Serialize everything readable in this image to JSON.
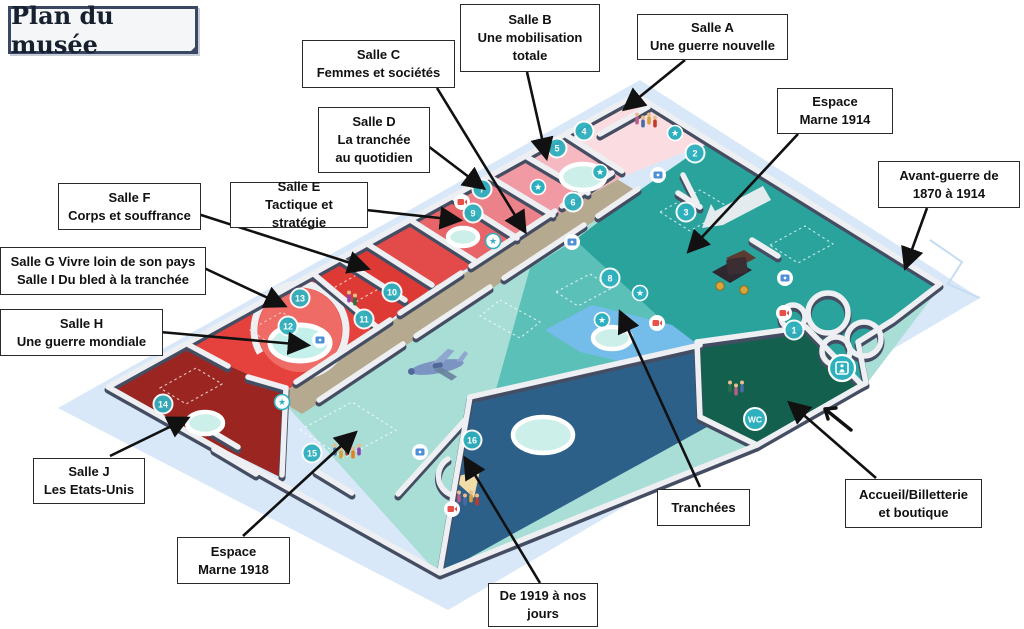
{
  "title": "Plan du musée",
  "labels": {
    "salle_b": "Salle B\nUne mobilisation\ntotale",
    "salle_a": "Salle A\nUne guerre nouvelle",
    "salle_c": "Salle C\nFemmes et sociétés",
    "salle_d": "Salle D\nLa tranchée\nau quotidien",
    "marne_1914": "Espace\nMarne 1914",
    "salle_f": "Salle F\nCorps et souffrance",
    "salle_e": "Salle E\nTactique et stratégie",
    "avant_guerre": "Avant-guerre de\n1870 à 1914",
    "salle_g_i": "Salle G Vivre loin de son pays\nSalle I Du bled à la tranchée",
    "salle_h": "Salle H\nUne guerre mondiale",
    "salle_j": "Salle J\nLes Etats-Unis",
    "marne_1918": "Espace\nMarne 1918",
    "tranchees": "Tranchées",
    "accueil": "Accueil/Billetterie\net boutique",
    "de_1919": "De 1919 à nos\njours"
  },
  "map": {
    "colors": {
      "bg_diamond": "#D8E8F8",
      "teal_dark": "#2AA39D",
      "teal_medium": "#5BC0B8",
      "teal_light": "#A9DED6",
      "navy": "#2D6089",
      "green": "#14604E",
      "corridor": "#B5A98F",
      "dark_red": "#9B2621",
      "red_h": "#E6423D",
      "court": "#EE6B66",
      "pond": "#74BCE9",
      "wall_face": "#EDEFF2",
      "wall_top": "#454D63",
      "room_a": "#FBDCE1",
      "room_b": "#F6B9C1",
      "room_c": "#F19AA4",
      "room_d": "#EC8289",
      "room_e": "#E76568",
      "room_f": "#E24B49",
      "room_g": "#DD3A36",
      "marker": "#2FB0BE",
      "badge_blue": "#4E8FD8",
      "badge_red": "#E8504A",
      "arrow_black": "#111111"
    },
    "markers": [
      {
        "n": "1",
        "x": 794,
        "y": 330
      },
      {
        "n": "2",
        "x": 695,
        "y": 153
      },
      {
        "n": "3",
        "x": 686,
        "y": 212
      },
      {
        "n": "4",
        "x": 584,
        "y": 131
      },
      {
        "n": "5",
        "x": 557,
        "y": 148
      },
      {
        "n": "6",
        "x": 573,
        "y": 202
      },
      {
        "n": "7",
        "x": 482,
        "y": 189
      },
      {
        "n": "8",
        "x": 610,
        "y": 278
      },
      {
        "n": "9",
        "x": 473,
        "y": 213
      },
      {
        "n": "10",
        "x": 392,
        "y": 292
      },
      {
        "n": "11",
        "x": 364,
        "y": 319
      },
      {
        "n": "12",
        "x": 288,
        "y": 326
      },
      {
        "n": "13",
        "x": 300,
        "y": 298
      },
      {
        "n": "14",
        "x": 163,
        "y": 404
      },
      {
        "n": "15",
        "x": 312,
        "y": 453
      },
      {
        "n": "16",
        "x": 472,
        "y": 440
      }
    ],
    "badges": {
      "wc": {
        "label": "WC",
        "x": 755,
        "y": 419
      },
      "elevator": {
        "x": 842,
        "y": 368
      }
    },
    "stars": [
      {
        "x": 675,
        "y": 133,
        "style": "teal"
      },
      {
        "x": 600,
        "y": 172,
        "style": "teal"
      },
      {
        "x": 538,
        "y": 187,
        "style": "teal"
      },
      {
        "x": 602,
        "y": 320,
        "style": "teal"
      },
      {
        "x": 640,
        "y": 293,
        "style": "teal"
      },
      {
        "x": 493,
        "y": 241,
        "style": "white"
      },
      {
        "x": 282,
        "y": 402,
        "style": "white"
      }
    ],
    "media_blue": [
      {
        "x": 658,
        "y": 175
      },
      {
        "x": 785,
        "y": 278
      },
      {
        "x": 320,
        "y": 340
      },
      {
        "x": 420,
        "y": 452
      },
      {
        "x": 572,
        "y": 242
      }
    ],
    "media_red": [
      {
        "x": 462,
        "y": 202
      },
      {
        "x": 657,
        "y": 323
      },
      {
        "x": 784,
        "y": 313
      },
      {
        "x": 452,
        "y": 509
      }
    ],
    "ovals": [
      {
        "x": 583,
        "y": 177,
        "rx": 22,
        "ry": 13
      },
      {
        "x": 463,
        "y": 237,
        "rx": 15,
        "ry": 9
      },
      {
        "x": 205,
        "y": 423,
        "rx": 18,
        "ry": 11
      },
      {
        "x": 543,
        "y": 435,
        "rx": 30,
        "ry": 18
      },
      {
        "x": 612,
        "y": 338,
        "rx": 19,
        "ry": 11
      }
    ],
    "people_clusters": [
      {
        "x": 646,
        "y": 122,
        "count": 4
      },
      {
        "x": 352,
        "y": 300,
        "count": 2
      },
      {
        "x": 347,
        "y": 453,
        "count": 5
      },
      {
        "x": 468,
        "y": 500,
        "count": 4
      },
      {
        "x": 736,
        "y": 390,
        "count": 3
      }
    ],
    "people_palette": [
      "#C0392B",
      "#E67E22",
      "#8E44AD",
      "#2C6E49",
      "#B85C8A",
      "#4A69A5",
      "#D4A13A"
    ]
  }
}
